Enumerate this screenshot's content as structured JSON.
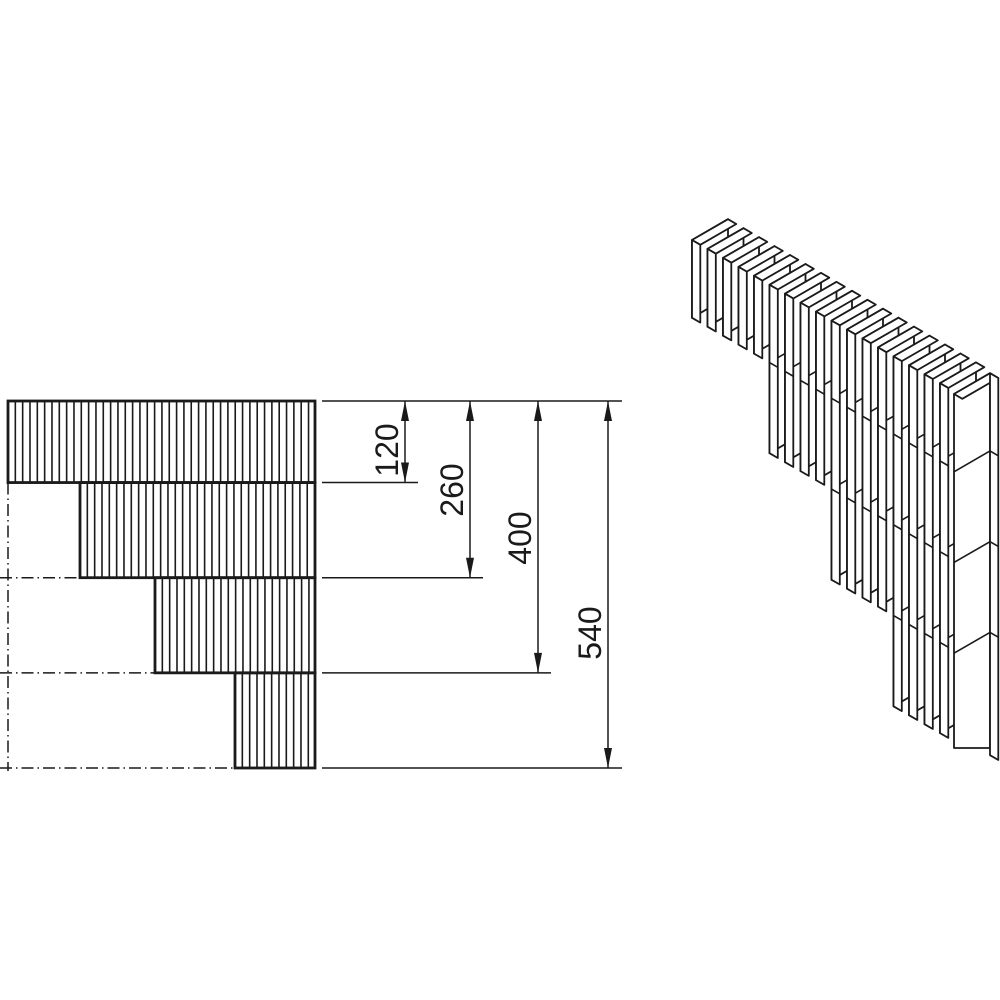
{
  "title": "Stepped lamella wall corner — technical drawing",
  "line_color": "#1a1a1a",
  "background_color": "#ffffff",
  "dimensions": [
    {
      "label": "120",
      "value": 120
    },
    {
      "label": "260",
      "value": 260
    },
    {
      "label": "400",
      "value": 400
    },
    {
      "label": "540",
      "value": 540
    }
  ],
  "diagram": {
    "type": "technical_drawing",
    "description": "Corner detail of a stepped vertical-lamella wall: front elevation with stacked dimension chain (120/260/400/540) and isometric view of the slatted steps",
    "elevation": {
      "courses": 4,
      "course_boundaries_from_top": [
        120,
        260,
        400,
        540
      ],
      "stepped": true,
      "centerline_style": "dash-dot"
    },
    "isometric": {
      "lamellae_per_step": [
        5,
        4,
        4,
        4
      ],
      "end_post": true,
      "step_depths_from_top": [
        120,
        260,
        400,
        540
      ]
    }
  }
}
